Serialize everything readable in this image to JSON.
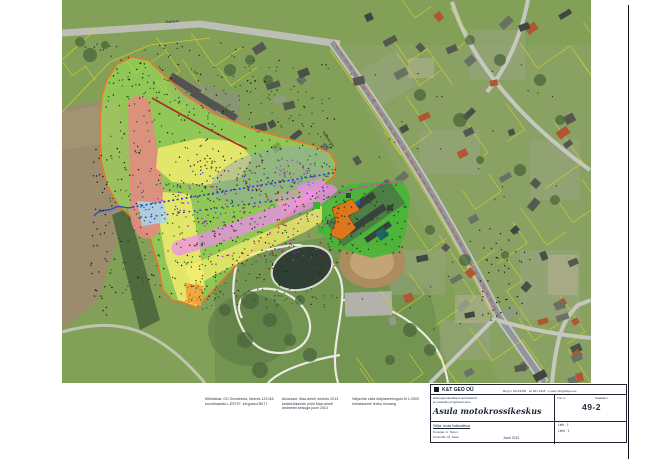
{
  "sheet": {
    "background": "#ffffff",
    "border_color": "#111111"
  },
  "map": {
    "description": "aerial-orthophoto-with-planning-overlay",
    "labels": {
      "top_road": "Jaama tn",
      "diag_road": "Tallinna mnt"
    },
    "zones": {
      "green_main": {
        "label": "planning-area",
        "fill": "#9ce354",
        "opacity": 0.58,
        "stroke": "#e8762c",
        "stroke_width": 1.6
      },
      "red_blob": {
        "label": "red-zone",
        "fill": "#e88884",
        "opacity": 0.85
      },
      "yellow_upper": {
        "label": "yellow-zone-upper",
        "fill": "#f6ee6e",
        "opacity": 0.8
      },
      "yellow_strip": {
        "label": "yellow-zone-strip",
        "fill": "#f6ee6e",
        "opacity": 0.8
      },
      "yellow_band": {
        "label": "yellow-zone-lower",
        "fill": "#f6ee6e",
        "opacity": 0.75
      },
      "orange_tip": {
        "label": "orange-zone-tip",
        "fill": "#eda33c",
        "opacity": 0.9
      },
      "light_blue": {
        "label": "light-blue-zone",
        "fill": "#a6d6f0",
        "opacity": 0.85
      },
      "gray_overlay": {
        "label": "gray-analysis-area",
        "fill": "#93a4ac",
        "opacity": 0.48
      },
      "salmon": {
        "label": "salmon-zone",
        "fill": "#f0ae9c",
        "opacity": 0.75
      },
      "facility_green": {
        "label": "facility-site",
        "fill": "#46b636",
        "opacity": 0.9
      },
      "facility_gray": {
        "label": "facility-yard",
        "fill": "#4a544e",
        "opacity": 0.55
      }
    },
    "line_colors": {
      "boundary_orange": "#e8762c",
      "dam_red": "#a83226",
      "survey_blue": "#2746c8",
      "cadastral_yellow": "#d6d228",
      "boundary_magenta": "#e43cc8",
      "road_edge_red": "#d04818"
    },
    "scatter": [
      {
        "name": "overlay-green-dots",
        "region": [
          108,
          66,
          225,
          235
        ],
        "count": 420,
        "color": "#1e6018",
        "r": 0.7,
        "seed": 11
      },
      {
        "name": "overlay-black-dots",
        "region": [
          105,
          60,
          230,
          245
        ],
        "count": 200,
        "color": "#141414",
        "r": 0.7,
        "seed": 12
      },
      {
        "name": "overlay-brown-dots",
        "region": [
          195,
          160,
          145,
          110
        ],
        "count": 150,
        "color": "#70380e",
        "r": 0.8,
        "seed": 13
      },
      {
        "name": "overlay-magenta-dots",
        "region": [
          150,
          185,
          185,
          75
        ],
        "count": 100,
        "color": "#cc22cc",
        "r": 0.8,
        "seed": 14
      },
      {
        "name": "overlay-blue-dots",
        "region": [
          130,
          170,
          205,
          55
        ],
        "count": 70,
        "color": "#2443bb",
        "r": 0.7,
        "seed": 15
      },
      {
        "name": "violet-cluster",
        "region": [
          272,
          160,
          45,
          28
        ],
        "count": 40,
        "color": "#a050d0",
        "r": 0.8,
        "seed": 16
      },
      {
        "name": "orange-tip-dots",
        "region": [
          184,
          282,
          20,
          25
        ],
        "count": 28,
        "color": "#e07818",
        "r": 0.8,
        "seed": 17
      },
      {
        "name": "left-road-points",
        "region": [
          90,
          140,
          18,
          175
        ],
        "count": 40,
        "color": "#141414",
        "r": 0.7,
        "seed": 18
      },
      {
        "name": "top-road-points",
        "region": [
          85,
          42,
          160,
          16
        ],
        "count": 26,
        "color": "#141414",
        "r": 0.6,
        "seed": 19
      },
      {
        "name": "facility-green-dots",
        "region": [
          326,
          186,
          82,
          68
        ],
        "count": 70,
        "color": "#11500f",
        "r": 0.8,
        "seed": 20
      },
      {
        "name": "facility-east-points",
        "region": [
          478,
          228,
          48,
          95
        ],
        "count": 45,
        "color": "#1a1a1a",
        "r": 0.7,
        "seed": 21
      },
      {
        "name": "residential-specks",
        "region": [
          350,
          60,
          230,
          300
        ],
        "count": 40,
        "color": "#222222",
        "r": 0.6,
        "seed": 22
      },
      {
        "name": "overlay-edge-green",
        "region": [
          190,
          250,
          150,
          60
        ],
        "count": 80,
        "color": "#1e6018",
        "r": 0.7,
        "seed": 23
      }
    ],
    "houses": [
      {
        "name": "residential-houses-east",
        "region": [
          352,
          6,
          232,
          370
        ],
        "count": 48,
        "seed": 31,
        "colors": [
          "#54584f",
          "#6b7064",
          "#4a4f47",
          "#b05632",
          "#8f9b86",
          "#3f4540",
          "#6b7064",
          "#b05632"
        ]
      },
      {
        "name": "houses-along-road",
        "region": [
          248,
          40,
          95,
          120
        ],
        "count": 12,
        "seed": 32,
        "colors": [
          "#54584f",
          "#6b7064",
          "#4a4f47",
          "#8f9b86"
        ]
      },
      {
        "name": "houses-southeast",
        "region": [
          505,
          300,
          80,
          80
        ],
        "count": 8,
        "seed": 33,
        "colors": [
          "#54584f",
          "#6b7064",
          "#b05632",
          "#3f4540"
        ]
      }
    ],
    "parcels": [
      {
        "name": "cadastral-lines-east",
        "region": [
          345,
          0,
          245,
          383
        ],
        "count": 26,
        "seed": 41,
        "color": "#d6d228"
      },
      {
        "name": "cadastral-lines-west",
        "region": [
          62,
          10,
          200,
          110
        ],
        "count": 6,
        "seed": 42,
        "color": "#d6d228"
      }
    ]
  },
  "notes": {
    "block1": {
      "lines": [
        "Mõõdistas: OÜ Geodeesia, litsents 123 MA",
        "koordinaadid L-EST97, kõrgused BK77"
      ]
    },
    "block2": {
      "lines": [
        "Aluskaart: Maa-ameti ortofoto 2013",
        "katastriüksuste piirid Maa-ameti",
        "andmetel seisuga juuni 2013"
      ]
    },
    "block3": {
      "lines": [
        "Väljavõte valla üldplaneeringust M 1:2000",
        "mürataseme leviku hinnang"
      ]
    }
  },
  "title_block": {
    "company": "K&T GEO OÜ",
    "company_info": "Reg nr 10123456 · tel 601 2345 · e-post info@ktgeo.ee",
    "left_line1": "Ehitusgeodeetilised uurimistööd",
    "left_line2": "ja maastiku projekteerimine",
    "work_no_label": "Töö nr",
    "stage_label": "Staadium",
    "drawing_no": "49-2",
    "project_title": "Asula motokrossikeskus",
    "client_label": "Tellija: Asula Vallavalitsus",
    "made_by": "Koostas: A. Tamm",
    "checked_by": "Kontrollis: M. Kask",
    "date": "Juuni 2013",
    "sheet_label": "Leht",
    "sheet_no": "1",
    "sheets_label": "Lehti",
    "sheets_no": "1"
  }
}
